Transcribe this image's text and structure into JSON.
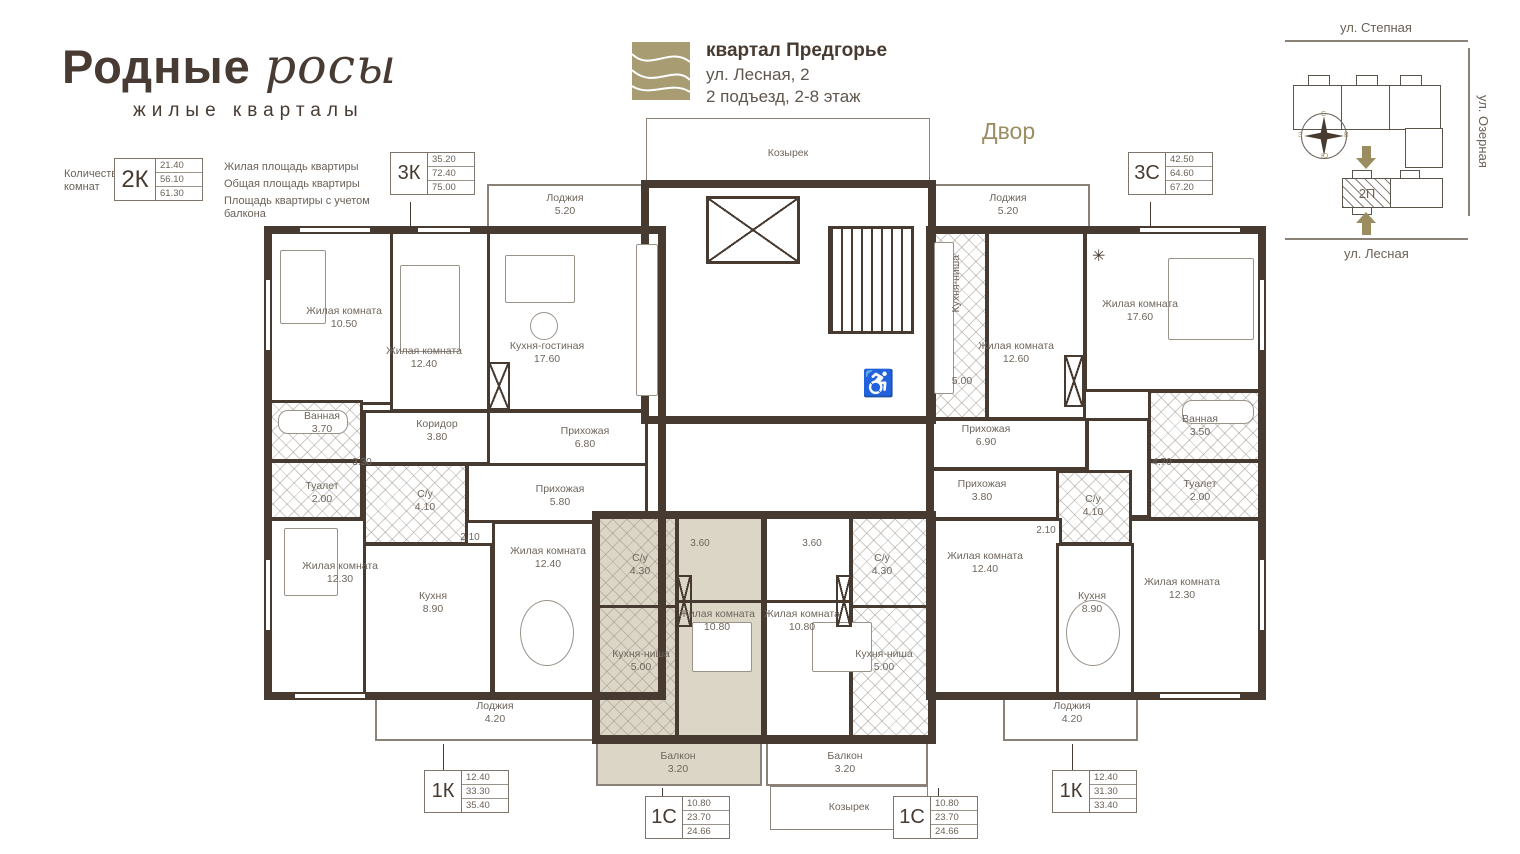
{
  "logo": {
    "title_main": "Родные",
    "title_script": "росы",
    "subtitle": "жилые кварталы"
  },
  "legend": {
    "label": "Количество комнат",
    "code": "2К",
    "values": [
      "21.40",
      "56.10",
      "61.30"
    ],
    "descriptions": [
      "Жилая площадь квартиры",
      "Общая площадь квартиры",
      "Площадь квартиры с учетом балкона"
    ]
  },
  "header": {
    "quarter": "квартал Предгорье",
    "address": "ул. Лесная, 2",
    "entrance": "2 подъезд, 2-8 этаж"
  },
  "yard": "Двор",
  "site": {
    "street_top": "ул. Степная",
    "street_right": "ул. Озерная",
    "street_bottom": "ул. Лесная",
    "block_label": "2П",
    "compass": {
      "n": "С",
      "e": "В",
      "s": "Ю",
      "w": "З"
    }
  },
  "canopy": {
    "top": "Козырек",
    "bottom": "Козырек"
  },
  "tags": [
    {
      "code": "3К",
      "values": [
        "35.20",
        "72.40",
        "75.00"
      ]
    },
    {
      "code": "3С",
      "values": [
        "42.50",
        "64.60",
        "67.20"
      ]
    },
    {
      "code": "1К",
      "values": [
        "12.40",
        "33.30",
        "35.40"
      ]
    },
    {
      "code": "1С",
      "values": [
        "10.80",
        "23.70",
        "24.66"
      ]
    },
    {
      "code": "1С",
      "values": [
        "10.80",
        "23.70",
        "24.66"
      ]
    },
    {
      "code": "1К",
      "values": [
        "12.40",
        "31.30",
        "33.40"
      ]
    }
  ],
  "rooms": [
    {
      "name": "Жилая комната",
      "area": "10.50"
    },
    {
      "name": "Жилая комната",
      "area": "12.40"
    },
    {
      "name": "Кухня-гостиная",
      "area": "17.60"
    },
    {
      "name": "Коридор",
      "area": "3.80"
    },
    {
      "name": "Прихожая",
      "area": "6.80"
    },
    {
      "name": "Ванная",
      "area": "3.70"
    },
    {
      "name": "Туалет",
      "area": "2.00"
    },
    {
      "name": "Жилая комната",
      "area": "12.30"
    },
    {
      "name": "С/у",
      "area": "4.10"
    },
    {
      "name": "Прихожая",
      "area": "5.80"
    },
    {
      "name": "Кухня",
      "area": "8.90"
    },
    {
      "name": "Жилая комната",
      "area": "12.40"
    },
    {
      "name": "Лоджия",
      "area": "4.20"
    },
    {
      "name": "Лоджия",
      "area": "5.20"
    },
    {
      "name": "С/у",
      "area": "4.30"
    },
    {
      "name": "Жилая комната",
      "area": "10.80"
    },
    {
      "name": "Кухня-ниша",
      "area": "5.00"
    },
    {
      "name": "Балкон",
      "area": "3.20"
    },
    {
      "name": "Жилая комната",
      "area": "10.80"
    },
    {
      "name": "С/у",
      "area": "4.30"
    },
    {
      "name": "Кухня-ниша",
      "area": "5.00"
    },
    {
      "name": "Балкон",
      "area": "3.20"
    },
    {
      "name": "Кухня-ниша",
      "area": "5.00"
    },
    {
      "name": "Жилая комната",
      "area": "12.60"
    },
    {
      "name": "Жилая комната",
      "area": "17.60"
    },
    {
      "name": "Прихожая",
      "area": "6.90"
    },
    {
      "name": "Ванная",
      "area": "3.50"
    },
    {
      "name": "Туалет",
      "area": "2.00"
    },
    {
      "name": "Жилая комната",
      "area": "12.30"
    },
    {
      "name": "Прихожая",
      "area": "3.80"
    },
    {
      "name": "С/у",
      "area": "4.10"
    },
    {
      "name": "Кухня",
      "area": "8.90"
    },
    {
      "name": "Жилая комната",
      "area": "12.40"
    },
    {
      "name": "Лоджия",
      "area": "4.20"
    },
    {
      "name": "Лоджия",
      "area": "5.20"
    }
  ],
  "dims": [
    "3.30",
    "2.10",
    "3.60",
    "3.60",
    "2.10",
    "4.70"
  ],
  "icons": {
    "wheelchair": "♿",
    "snowflake": "✳"
  }
}
